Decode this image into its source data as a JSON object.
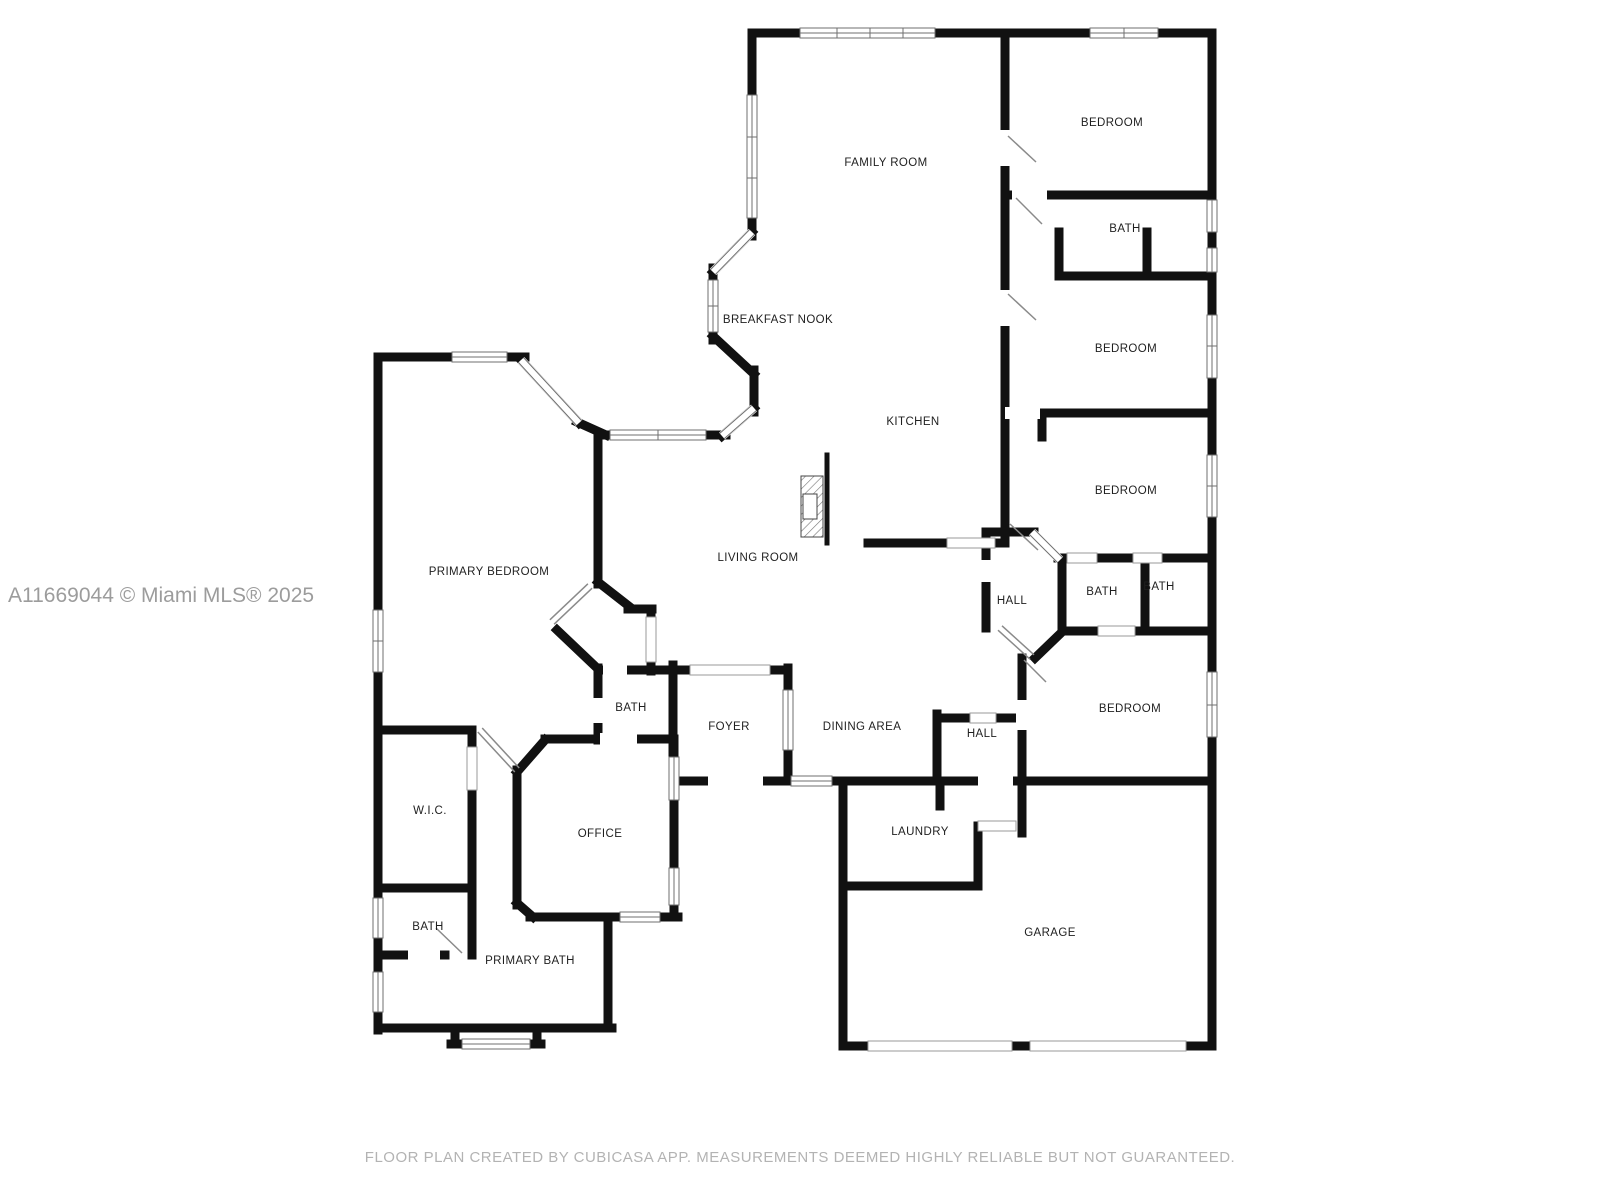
{
  "watermark": "A11669044 © Miami MLS® 2025",
  "disclaimer": "FLOOR PLAN CREATED BY CUBICASA APP. MEASUREMENTS DEEMED HIGHLY RELIABLE BUT NOT GUARANTEED.",
  "colors": {
    "wall": "#111111",
    "window_frame": "#6f6f6f",
    "label_text": "#1f1f1f",
    "watermark_text": "#9c9c9c",
    "disclaimer_text": "#b3b3b3",
    "background": "#ffffff"
  },
  "icons": {
    "fireplace": "fireplace-hatch-icon"
  },
  "rooms": {
    "family_room": {
      "label": "FAMILY ROOM"
    },
    "bedroom_1": {
      "label": "BEDROOM"
    },
    "bath_1": {
      "label": "BATH"
    },
    "bedroom_2": {
      "label": "BEDROOM"
    },
    "breakfast_nook": {
      "label": "BREAKFAST NOOK"
    },
    "kitchen": {
      "label": "KITCHEN"
    },
    "bedroom_3": {
      "label": "BEDROOM"
    },
    "primary_bedroom": {
      "label": "PRIMARY BEDROOM"
    },
    "living_room": {
      "label": "LIVING ROOM"
    },
    "hall_1": {
      "label": "HALL"
    },
    "bath_2": {
      "label": "BATH"
    },
    "bath_3": {
      "label": "BATH"
    },
    "bedroom_4": {
      "label": "BEDROOM"
    },
    "bath_4": {
      "label": "BATH"
    },
    "foyer": {
      "label": "FOYER"
    },
    "dining_area": {
      "label": "DINING AREA"
    },
    "hall_2": {
      "label": "HALL"
    },
    "wic": {
      "label": "W.I.C."
    },
    "office": {
      "label": "OFFICE"
    },
    "laundry": {
      "label": "LAUNDRY"
    },
    "bath_5": {
      "label": "BATH"
    },
    "primary_bath": {
      "label": "PRIMARY BATH"
    },
    "garage": {
      "label": "GARAGE"
    }
  }
}
